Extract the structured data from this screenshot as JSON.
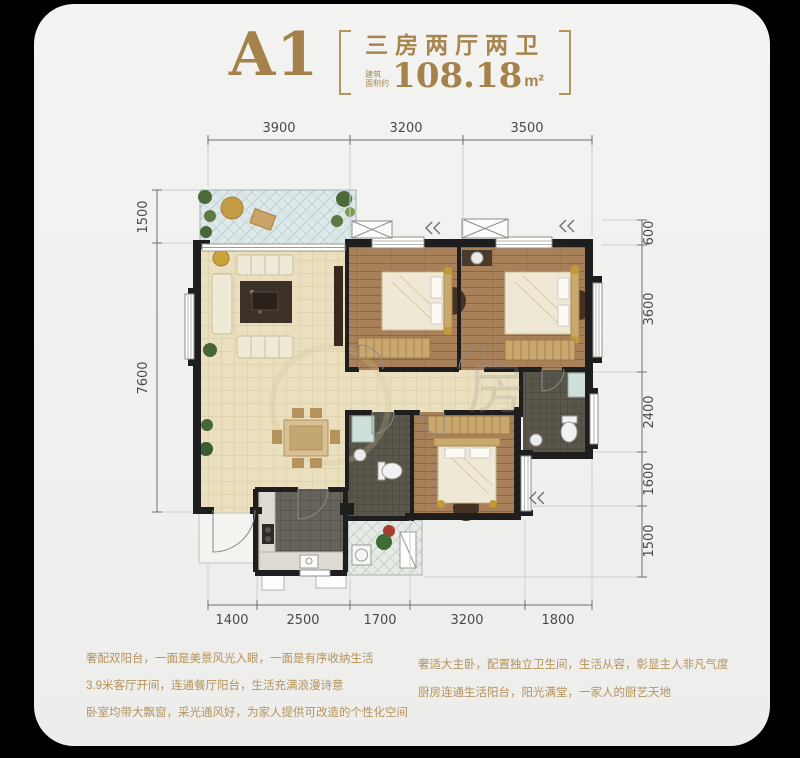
{
  "header": {
    "plan_code": "A1",
    "layout": "三房两厅两卫",
    "area_prefix_top": "建筑",
    "area_prefix_bottom": "面积约",
    "area_value": "108.18",
    "area_unit": "m²"
  },
  "dimensions": {
    "top": [
      "3900",
      "3200",
      "3500"
    ],
    "bottom": [
      "1400",
      "2500",
      "1700",
      "3200",
      "1800"
    ],
    "left": [
      "1500",
      "7600"
    ],
    "right": [
      "600",
      "3600",
      "2400",
      "1600",
      "1500"
    ]
  },
  "watermark": "房",
  "description": {
    "left_lines": [
      "奢配双阳台，一面是美景风光入眼，一面是有序收纳生活",
      "3.9米客厅开间，连通餐厅阳台，生活充满浪漫诗意",
      "卧室均带大飘窗，采光通风好，为家人提供可改造的个性化空间"
    ],
    "right_lines": [
      "奢适大主卧，配置独立卫生间，生活从容，彰显主人非凡气度",
      "厨房连通生活阳台，阳光满堂，一家人的厨艺天地"
    ]
  },
  "colors": {
    "gold": "#a8854f",
    "card_bg": "#f1f1ef",
    "wall": "#1e1e1e",
    "wood_floor": "#a8805a",
    "cream_floor": "#eae0bf",
    "dark_tile": "#5a564b",
    "balcony_tile": "#dfe8e9",
    "dim_text": "#4a4a4a"
  }
}
